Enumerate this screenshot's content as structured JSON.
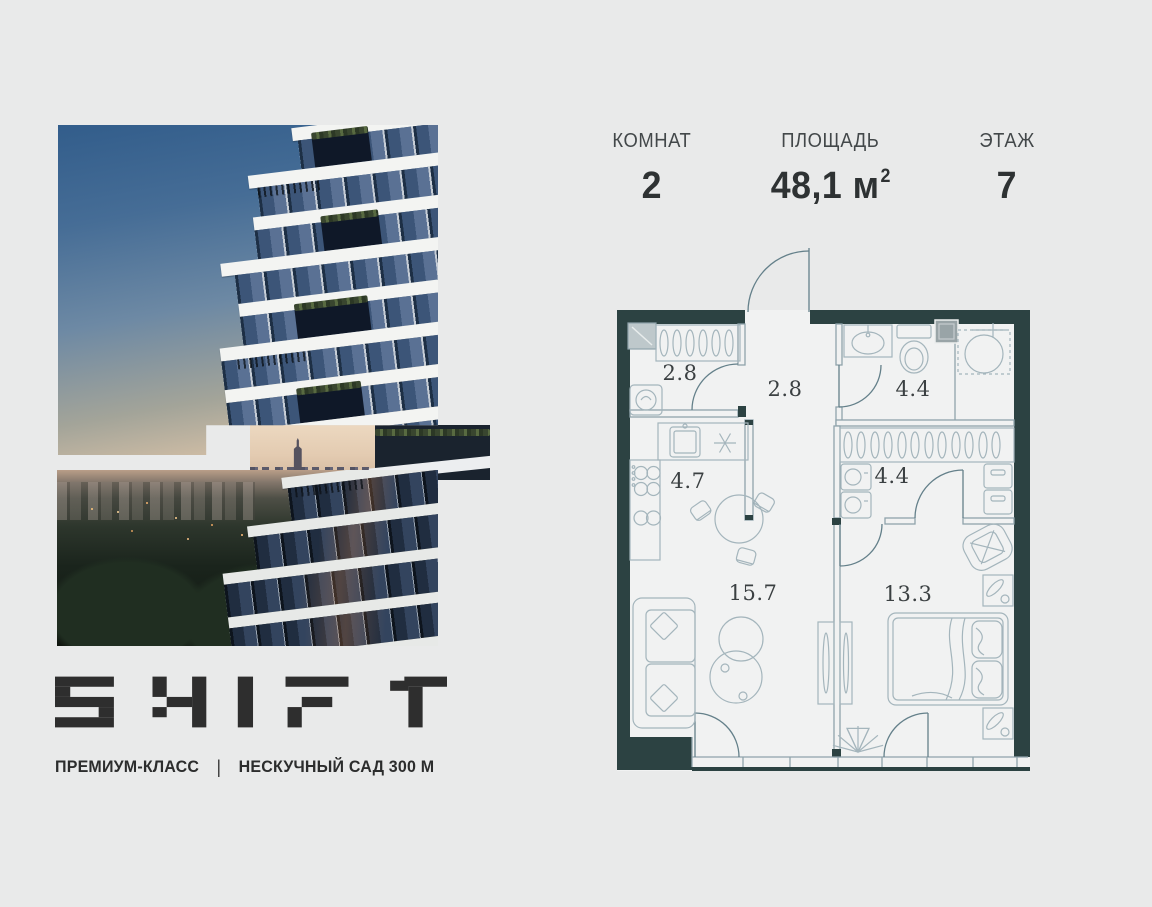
{
  "listing": {
    "stats": {
      "rooms": {
        "label": "КОМНАТ",
        "value": "2"
      },
      "area": {
        "label": "ПЛОЩАДЬ",
        "value": "48,1 м",
        "sup": "2"
      },
      "floor": {
        "label": "ЭТАЖ",
        "value": "7"
      }
    }
  },
  "branding": {
    "logo_text": "SHIFT",
    "premium_label": "ПРЕМИУМ-КЛАСС",
    "separator": "|",
    "location_label": "НЕСКУЧНЫЙ САД 300 М"
  },
  "floorplan": {
    "areas": {
      "storage": "2.8",
      "hallway": "2.8",
      "bathroom": "4.4",
      "kitchen": "4.7",
      "wardrobe": "4.4",
      "living": "15.7",
      "bedroom": "13.3"
    },
    "colors": {
      "wall": "#2c4242",
      "line": "#8fa3ab",
      "floor": "#f1f2f2",
      "label": "#3b4042"
    }
  }
}
